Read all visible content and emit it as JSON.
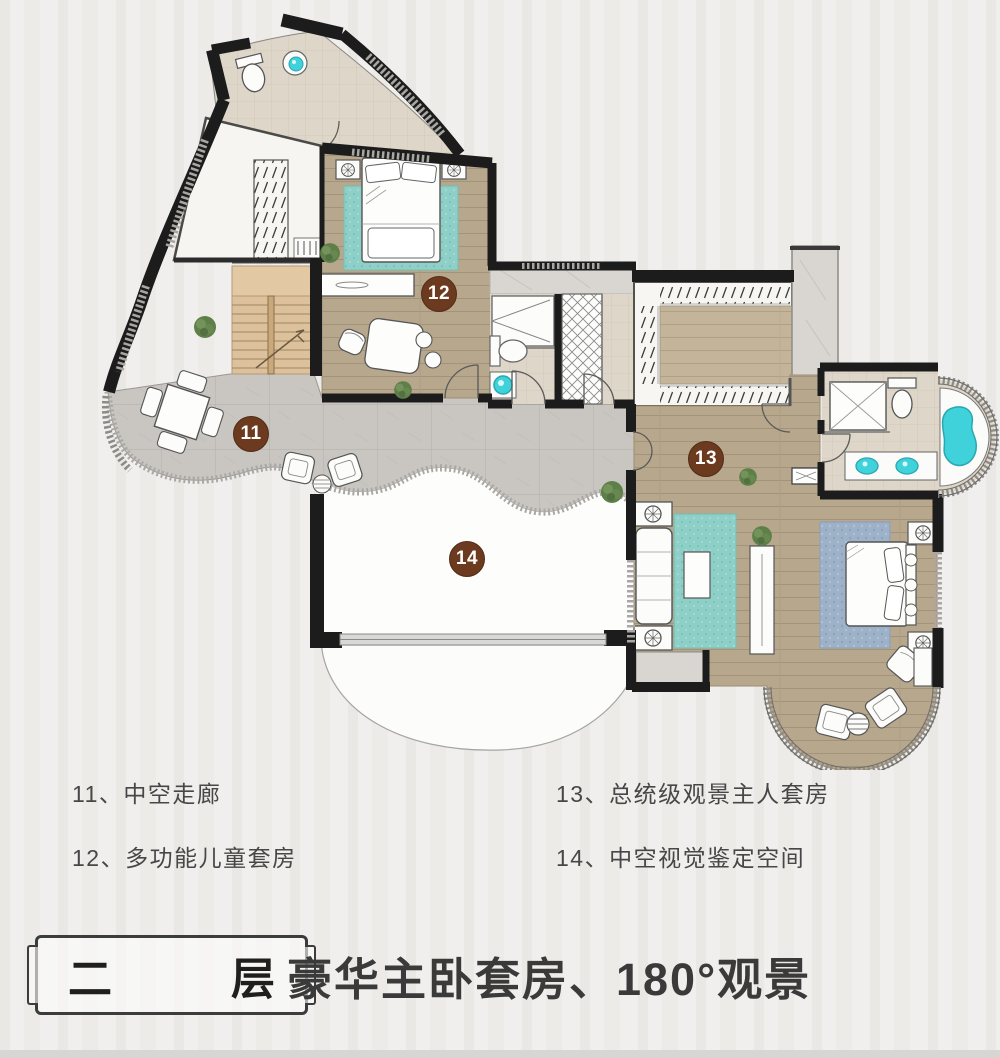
{
  "rooms": [
    {
      "number": "11",
      "name": "中空走廊"
    },
    {
      "number": "12",
      "name": "多功能儿童套房"
    },
    {
      "number": "13",
      "name": "总统级观景主人套房"
    },
    {
      "number": "14",
      "name": "中空视觉鉴定空间"
    }
  ],
  "legend": {
    "separator": "、"
  },
  "footer": {
    "floor_box": {
      "char_left": "二",
      "char_right": "层"
    },
    "subtitle": "豪华主卧套房、180°观景"
  },
  "colors": {
    "badge": "#6b3a1f",
    "badge_text": "#ffffff",
    "wall": "#1c1c1c",
    "wood_floor": "#b7a78d",
    "terrace_tile": "#c9c6c1",
    "bath_floor": "#ded6c8",
    "rug_teal": "#8ed0c7",
    "rug_blue": "#9db1c8",
    "fixture_cyan": "#3fd2da",
    "stairs": "#ddc09c",
    "plant_green": "#5e7f48"
  }
}
